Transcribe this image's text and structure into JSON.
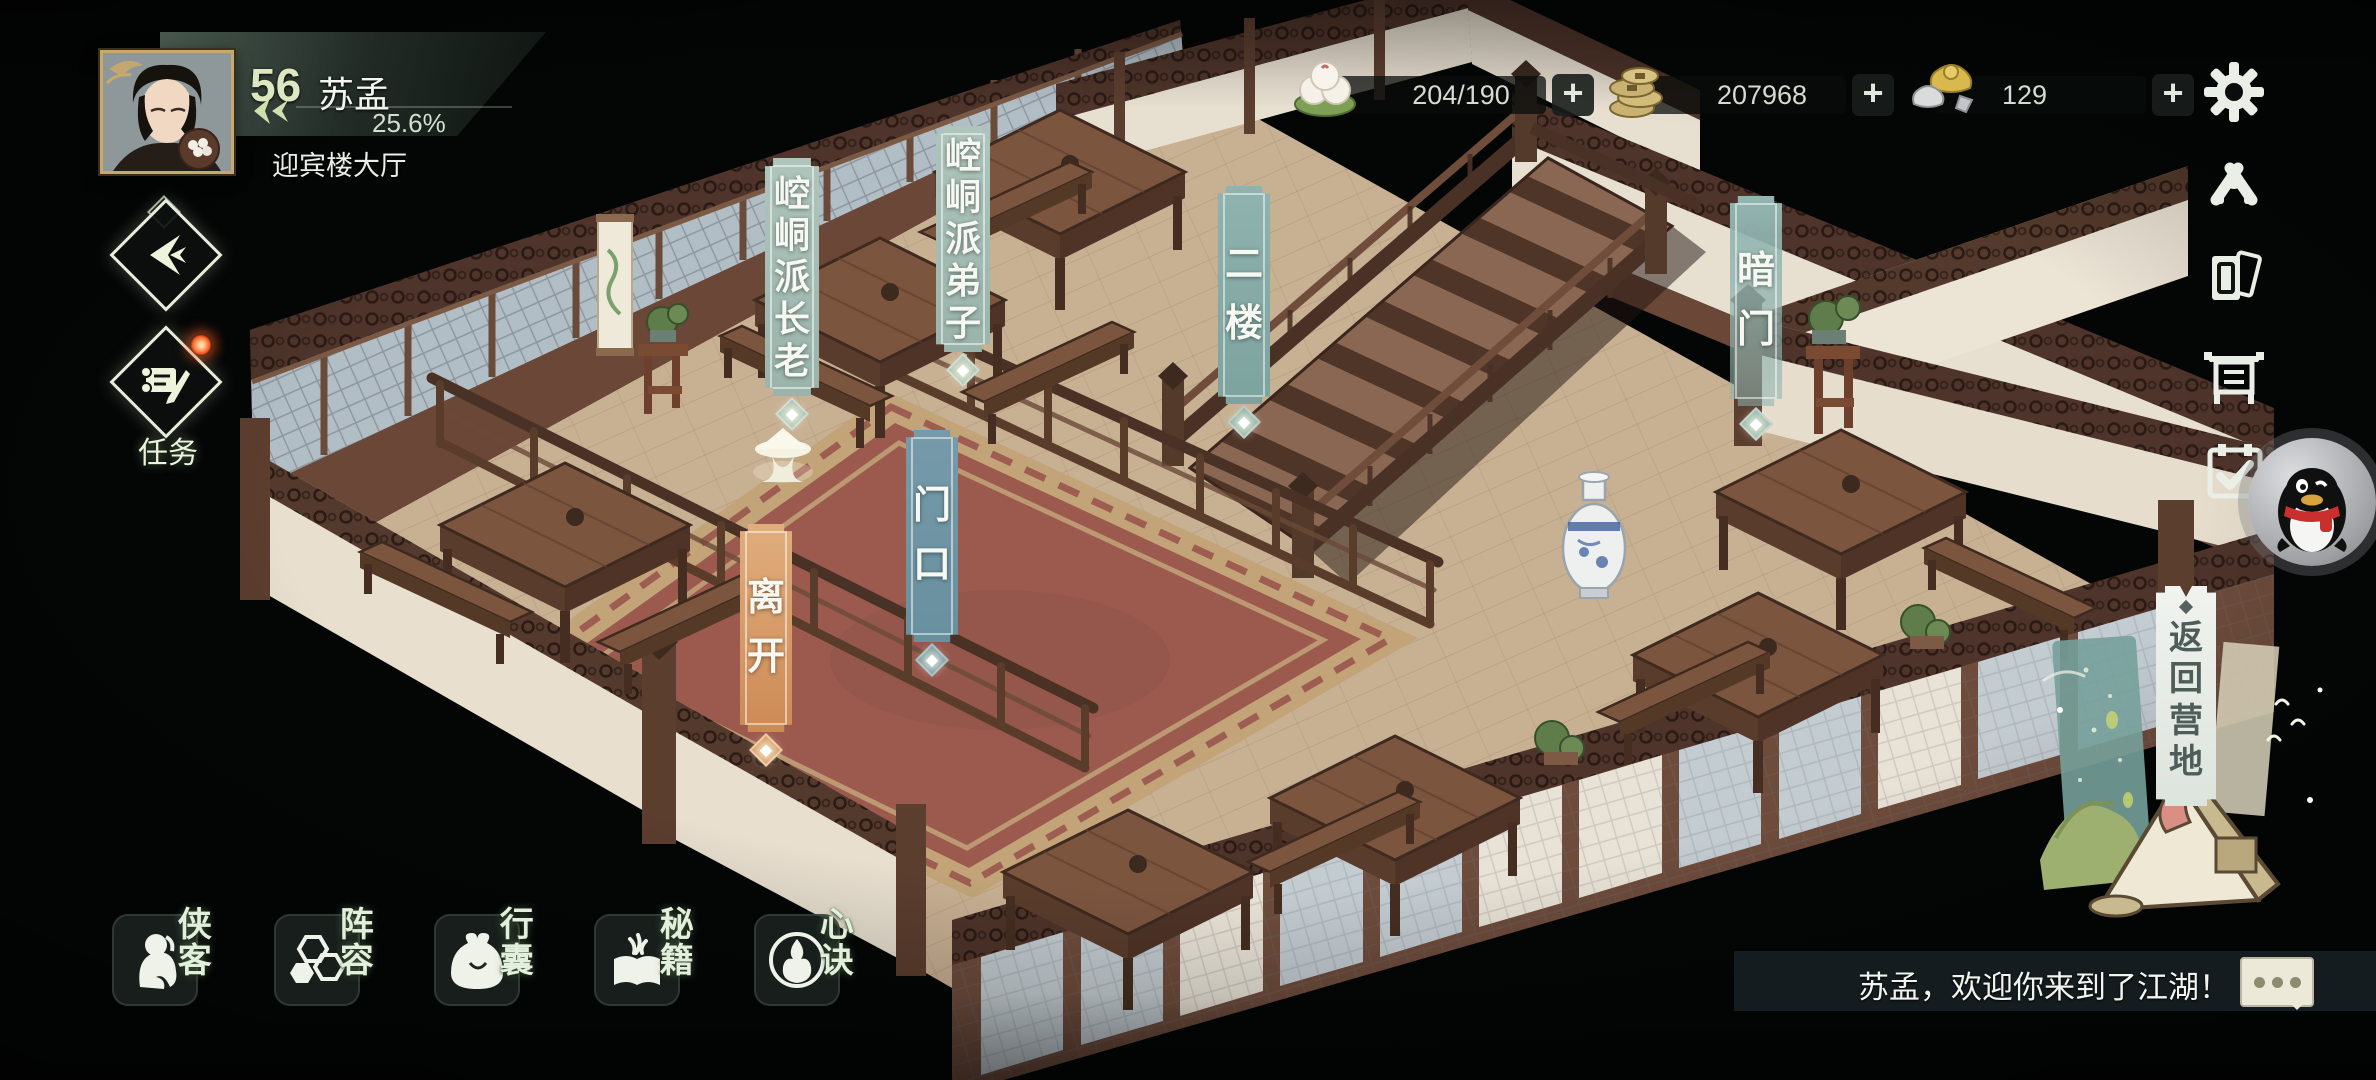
{
  "hud": {
    "player": {
      "level": "56",
      "name": "苏孟",
      "progress": "25.6%",
      "location": "迎宾楼大厅"
    },
    "resources": {
      "stamina": {
        "icon": "buns-icon",
        "value": "204/190"
      },
      "copper": {
        "icon": "coins-icon",
        "value": "207968"
      },
      "ingots": {
        "icon": "ingot-icon",
        "value": "129"
      }
    },
    "settings_icon": "gear-icon",
    "side_icons": [
      {
        "id": "ally",
        "icon": "handshake-icon"
      },
      {
        "id": "cards",
        "icon": "card-stack-icon"
      },
      {
        "id": "board",
        "icon": "notice-board-icon"
      },
      {
        "id": "signin",
        "icon": "calendar-check-icon"
      },
      {
        "id": "qq",
        "icon": "qq-penguin-icon"
      }
    ],
    "task": {
      "label": "任务",
      "has_notification": true
    },
    "menu": [
      {
        "id": "heroes",
        "label": "侠客",
        "icon": "hero-icon"
      },
      {
        "id": "formation",
        "label": "阵容",
        "icon": "hexagons-icon"
      },
      {
        "id": "bag",
        "label": "行囊",
        "icon": "pouch-icon"
      },
      {
        "id": "manuals",
        "label": "秘籍",
        "icon": "book-icon"
      },
      {
        "id": "mindset",
        "label": "心诀",
        "icon": "flame-icon"
      }
    ],
    "return_home": {
      "label": "返回营地"
    },
    "message": {
      "text": "苏孟，欢迎你来到了江湖！",
      "icon": "chat-bubble-icon"
    }
  },
  "scene": {
    "labels": [
      {
        "id": "kongtong-elder",
        "text": "崆峒派长老",
        "color": "#a5beb5"
      },
      {
        "id": "kongtong-disciple",
        "text": "崆峒派弟子",
        "color": "#a5beb5"
      },
      {
        "id": "second-floor",
        "text": "二楼",
        "color": "#86aca8"
      },
      {
        "id": "hidden-door",
        "text": "暗门",
        "color": "#8db2ae"
      },
      {
        "id": "doorway",
        "text": "门口",
        "color": "#6d93a3"
      },
      {
        "id": "leave",
        "text": "离开",
        "color": "#d3945f"
      }
    ],
    "colors": {
      "floor": "#c8b093",
      "carpet": "#9c5a4f",
      "carpet_border": "#c2a478",
      "wall": "#e9e1d1",
      "wood": "#5c3e2f"
    }
  }
}
